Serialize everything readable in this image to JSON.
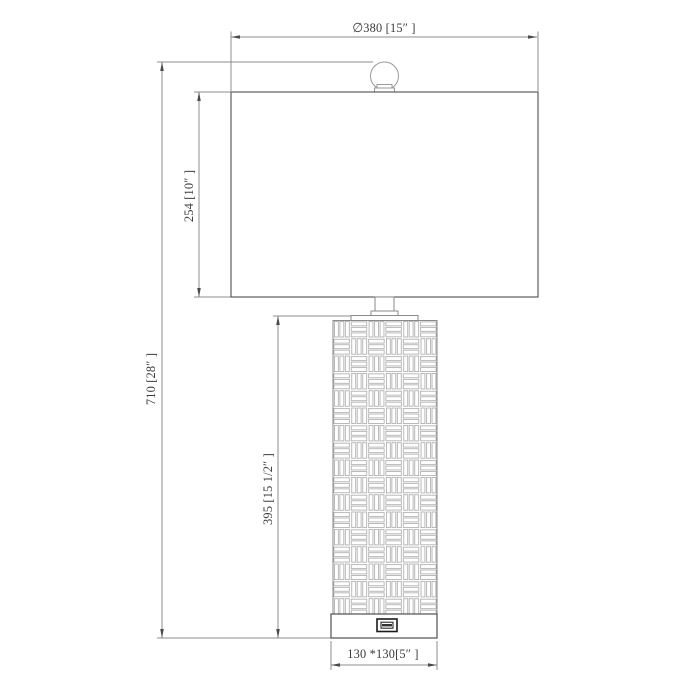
{
  "drawing": {
    "type": "technical-dimension-drawing",
    "subject": "table-lamp-with-woven-body-and-usb-port",
    "labels": {
      "shade_width": "∅380 [15″ ]",
      "shade_height": "254 [10″ ]",
      "total_height": "710 [28″ ]",
      "body_height": "395 [15 1/2″ ]",
      "base_size": "130 *130[5″ ]"
    },
    "colors": {
      "object_line": "#4f4f4f",
      "light_line": "#9a9a9a",
      "dimension_line": "#8c8c8c",
      "pattern_line": "#a3a3a3",
      "text": "#3b3b3b",
      "background": "#ffffff"
    }
  }
}
